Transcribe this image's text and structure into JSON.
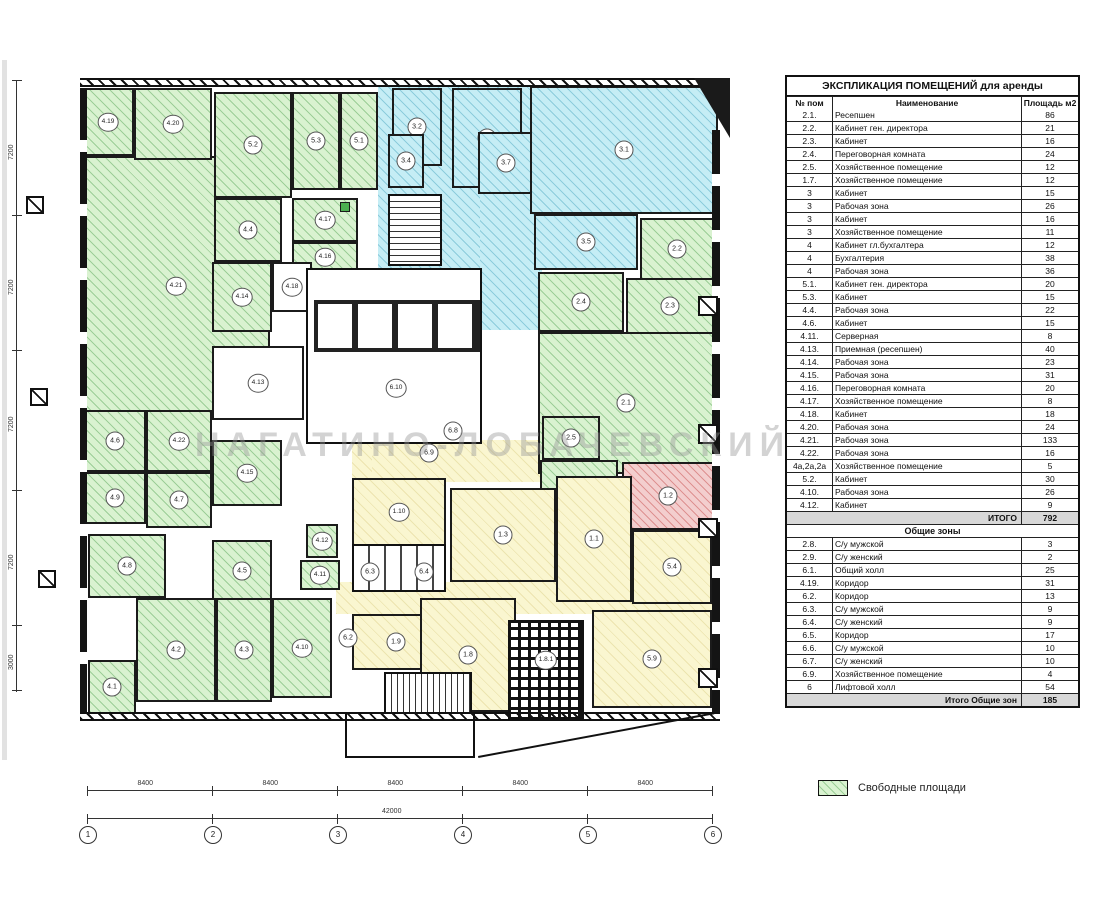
{
  "watermark": "НАГАТИНО-ЛОБАЧЕВСКИЙ",
  "legend": {
    "label": "Свободные площади"
  },
  "table": {
    "title": "ЭКСПЛИКАЦИЯ ПОМЕЩЕНИЙ для аренды",
    "columns": [
      "№ пом",
      "Наименование",
      "Площадь м2"
    ],
    "rows": [
      {
        "n": "2.1.",
        "name": "Ресепшен",
        "area": "86"
      },
      {
        "n": "2.2.",
        "name": "Кабинет ген. директора",
        "area": "21"
      },
      {
        "n": "2.3.",
        "name": "Кабинет",
        "area": "16"
      },
      {
        "n": "2.4.",
        "name": "Переговорная комната",
        "area": "24"
      },
      {
        "n": "2.5.",
        "name": "Хозяйственное помещение",
        "area": "12"
      },
      {
        "n": "1.7.",
        "name": "Хозяйственное помещение",
        "area": "12"
      },
      {
        "n": "3",
        "name": "Кабинет",
        "area": "15"
      },
      {
        "n": "3",
        "name": "Рабочая зона",
        "area": "26"
      },
      {
        "n": "3",
        "name": "Кабинет",
        "area": "16"
      },
      {
        "n": "3",
        "name": "Хозяйственное помещение",
        "area": "11"
      },
      {
        "n": "4",
        "name": "Кабинет гл.бухгалтера",
        "area": "12"
      },
      {
        "n": "4",
        "name": "Бухгалтерия",
        "area": "38"
      },
      {
        "n": "4",
        "name": "Рабочая зона",
        "area": "36"
      },
      {
        "n": "5.1.",
        "name": "Кабинет ген. директора",
        "area": "20"
      },
      {
        "n": "5.3.",
        "name": "Кабинет",
        "area": "15"
      },
      {
        "n": "4.4.",
        "name": "Рабочая зона",
        "area": "22"
      },
      {
        "n": "4.6.",
        "name": "Кабинет",
        "area": "15"
      },
      {
        "n": "4.11.",
        "name": "Серверная",
        "area": "8"
      },
      {
        "n": "4.13.",
        "name": "Приемная (ресепшен)",
        "area": "40"
      },
      {
        "n": "4.14.",
        "name": "Рабочая зона",
        "area": "23"
      },
      {
        "n": "4.15.",
        "name": "Рабочая зона",
        "area": "31"
      },
      {
        "n": "4.16.",
        "name": "Переговорная комната",
        "area": "20"
      },
      {
        "n": "4.17.",
        "name": "Хозяйственное помещение",
        "area": "8"
      },
      {
        "n": "4.18.",
        "name": "Кабинет",
        "area": "18"
      },
      {
        "n": "4.20.",
        "name": "Рабочая зона",
        "area": "24"
      },
      {
        "n": "4.21.",
        "name": "Рабочая зона",
        "area": "133"
      },
      {
        "n": "4.22.",
        "name": "Рабочая зона",
        "area": "16"
      },
      {
        "n": "4а,2а,2а",
        "name": "Хозяйственное помещение",
        "area": "5"
      },
      {
        "n": "5.2.",
        "name": "Кабинет",
        "area": "30"
      },
      {
        "n": "4.10.",
        "name": "Рабочая зона",
        "area": "26"
      },
      {
        "n": "4.12.",
        "name": "Кабинет",
        "area": "9"
      },
      {
        "type": "total",
        "label": "ИТОГО",
        "area": "792"
      },
      {
        "type": "section",
        "label": "Общие зоны"
      },
      {
        "n": "2.8.",
        "name": "С/у мужской",
        "area": "3"
      },
      {
        "n": "2.9.",
        "name": "С/у женский",
        "area": "2"
      },
      {
        "n": "6.1.",
        "name": "Общий холл",
        "area": "25"
      },
      {
        "n": "4.19.",
        "name": "Коридор",
        "area": "31"
      },
      {
        "n": "6.2.",
        "name": "Коридор",
        "area": "13"
      },
      {
        "n": "6.3.",
        "name": "С/у мужской",
        "area": "9"
      },
      {
        "n": "6.4.",
        "name": "С/у женский",
        "area": "9"
      },
      {
        "n": "6.5.",
        "name": "Коридор",
        "area": "17"
      },
      {
        "n": "6.6.",
        "name": "С/у мужской",
        "area": "10"
      },
      {
        "n": "6.7.",
        "name": "С/у женский",
        "area": "10"
      },
      {
        "n": "6.9.",
        "name": "Хозяйственное помещение",
        "area": "4"
      },
      {
        "n": "6",
        "name": "Лифтовой холл",
        "area": "54"
      },
      {
        "type": "total",
        "label": "Итого Общие зон",
        "area": "185"
      }
    ]
  },
  "plan": {
    "rooms": [
      {
        "f": "cn",
        "x": 378,
        "y": 85,
        "w": 164,
        "h": 190
      },
      {
        "f": "cn",
        "x": 480,
        "y": 190,
        "w": 60,
        "h": 140
      },
      {
        "f": "yn",
        "x": 352,
        "y": 440,
        "w": 190,
        "h": 42
      },
      {
        "f": "yn",
        "x": 352,
        "y": 386,
        "w": 20,
        "h": 100
      },
      {
        "f": "yn",
        "x": 336,
        "y": 582,
        "w": 376,
        "h": 32
      },
      {
        "l": "4.21",
        "x": 82,
        "y": 156,
        "w": 188,
        "h": 260,
        "f": "g"
      },
      {
        "l": "4.19",
        "x": 82,
        "y": 88,
        "w": 52,
        "h": 68,
        "f": "g"
      },
      {
        "l": "4.20",
        "x": 134,
        "y": 88,
        "w": 78,
        "h": 72,
        "f": "g"
      },
      {
        "l": "5.2",
        "x": 214,
        "y": 92,
        "w": 78,
        "h": 106,
        "f": "g"
      },
      {
        "l": "5.3",
        "x": 292,
        "y": 92,
        "w": 48,
        "h": 98,
        "f": "g"
      },
      {
        "l": "5.1",
        "x": 340,
        "y": 92,
        "w": 38,
        "h": 98,
        "f": "g"
      },
      {
        "l": "4.4",
        "x": 214,
        "y": 198,
        "w": 68,
        "h": 64,
        "f": "g"
      },
      {
        "l": "4.17",
        "x": 292,
        "y": 198,
        "w": 66,
        "h": 44,
        "f": "g"
      },
      {
        "l": "4.16",
        "x": 292,
        "y": 242,
        "w": 66,
        "h": 30,
        "f": "g"
      },
      {
        "l": "4.14",
        "x": 212,
        "y": 262,
        "w": 60,
        "h": 70,
        "f": "g"
      },
      {
        "l": "4.18",
        "x": 272,
        "y": 262,
        "w": 40,
        "h": 50,
        "f": "w"
      },
      {
        "l": "4.13",
        "x": 212,
        "y": 346,
        "w": 92,
        "h": 74,
        "f": "w"
      },
      {
        "l": "4.6",
        "x": 84,
        "y": 410,
        "w": 62,
        "h": 62,
        "f": "g"
      },
      {
        "l": "4.22",
        "x": 146,
        "y": 410,
        "w": 66,
        "h": 62,
        "f": "g"
      },
      {
        "l": "4.15",
        "x": 212,
        "y": 440,
        "w": 70,
        "h": 66,
        "f": "g"
      },
      {
        "l": "4.9",
        "x": 84,
        "y": 472,
        "w": 62,
        "h": 52,
        "f": "g"
      },
      {
        "l": "4.7",
        "x": 146,
        "y": 472,
        "w": 66,
        "h": 56,
        "f": "g"
      },
      {
        "l": "4.8",
        "x": 88,
        "y": 534,
        "w": 78,
        "h": 64,
        "f": "g"
      },
      {
        "l": "4.5",
        "x": 212,
        "y": 540,
        "w": 60,
        "h": 62,
        "f": "g"
      },
      {
        "l": "4.1",
        "x": 88,
        "y": 660,
        "w": 48,
        "h": 54,
        "f": "g"
      },
      {
        "l": "4.2",
        "x": 136,
        "y": 598,
        "w": 80,
        "h": 104,
        "f": "g"
      },
      {
        "l": "4.3",
        "x": 216,
        "y": 598,
        "w": 56,
        "h": 104,
        "f": "g"
      },
      {
        "l": "4.10",
        "x": 272,
        "y": 598,
        "w": 60,
        "h": 100,
        "f": "g"
      },
      {
        "l": "4.12",
        "x": 306,
        "y": 524,
        "w": 32,
        "h": 34,
        "f": "g"
      },
      {
        "l": "4.11",
        "x": 300,
        "y": 560,
        "w": 40,
        "h": 30,
        "f": "g"
      },
      {
        "l": "3.2",
        "x": 392,
        "y": 88,
        "w": 50,
        "h": 78,
        "f": "c"
      },
      {
        "l": "3.3",
        "x": 452,
        "y": 88,
        "w": 70,
        "h": 100,
        "f": "c"
      },
      {
        "l": "3.4",
        "x": 388,
        "y": 134,
        "w": 36,
        "h": 54,
        "f": "c"
      },
      {
        "l": "3.7",
        "x": 478,
        "y": 132,
        "w": 56,
        "h": 62,
        "f": "c"
      },
      {
        "l": "3.1",
        "x": 530,
        "y": 86,
        "w": 188,
        "h": 128,
        "f": "c"
      },
      {
        "l": "3.5",
        "x": 534,
        "y": 214,
        "w": 104,
        "h": 56,
        "f": "c"
      },
      {
        "l": "2.2",
        "x": 640,
        "y": 218,
        "w": 74,
        "h": 62,
        "f": "g"
      },
      {
        "l": "2.4",
        "x": 538,
        "y": 272,
        "w": 86,
        "h": 60,
        "f": "g"
      },
      {
        "l": "2.3",
        "x": 626,
        "y": 278,
        "w": 88,
        "h": 56,
        "f": "g"
      },
      {
        "l": "2.1",
        "x": 538,
        "y": 332,
        "w": 176,
        "h": 142,
        "f": "g"
      },
      {
        "l": "2.5",
        "x": 542,
        "y": 416,
        "w": 58,
        "h": 44,
        "f": "g"
      },
      {
        "l": "1.7",
        "x": 540,
        "y": 460,
        "w": 78,
        "h": 54,
        "f": "g"
      },
      {
        "l": "1.2",
        "x": 622,
        "y": 462,
        "w": 92,
        "h": 68,
        "f": "p"
      },
      {
        "l": "1.10",
        "x": 352,
        "y": 478,
        "w": 94,
        "h": 68,
        "f": "y"
      },
      {
        "l": "1.3",
        "x": 450,
        "y": 488,
        "w": 106,
        "h": 94,
        "f": "y"
      },
      {
        "l": "1.1",
        "x": 556,
        "y": 476,
        "w": 76,
        "h": 126,
        "f": "y"
      },
      {
        "l": "5.4",
        "x": 632,
        "y": 530,
        "w": 80,
        "h": 74,
        "f": "y"
      },
      {
        "l": "1.9",
        "x": 352,
        "y": 614,
        "w": 88,
        "h": 56,
        "f": "y"
      },
      {
        "l": "1.8",
        "x": 420,
        "y": 598,
        "w": 96,
        "h": 114,
        "f": "y"
      },
      {
        "l": "5.9",
        "x": 592,
        "y": 610,
        "w": 120,
        "h": 98,
        "f": "y"
      },
      {
        "l": "6.10",
        "x": 374,
        "y": 368,
        "w": 44,
        "h": 40,
        "f": "n"
      },
      {
        "l": "6.8",
        "x": 440,
        "y": 420,
        "w": 26,
        "h": 22,
        "f": "n"
      },
      {
        "l": "6.9",
        "x": 416,
        "y": 442,
        "w": 26,
        "h": 22,
        "f": "n"
      },
      {
        "l": "6.3",
        "x": 356,
        "y": 560,
        "w": 28,
        "h": 24,
        "f": "n"
      },
      {
        "l": "6.4",
        "x": 410,
        "y": 560,
        "w": 28,
        "h": 24,
        "f": "n"
      },
      {
        "l": "6.2",
        "x": 334,
        "y": 626,
        "w": 28,
        "h": 24,
        "f": "n"
      },
      {
        "l": "1.8.1",
        "x": 524,
        "y": 646,
        "w": 44,
        "h": 28,
        "f": "n"
      },
      {
        "f": "gs",
        "x": 340,
        "y": 202,
        "w": 10,
        "h": 10
      }
    ],
    "axis": {
      "bubbles": [
        "1",
        "2",
        "3",
        "4",
        "5",
        "6"
      ],
      "segments": [
        "8400",
        "8400",
        "8400",
        "8400",
        "8400"
      ],
      "total": "42000",
      "left": [
        "7200",
        "7200",
        "7200",
        "7200",
        "3000"
      ]
    }
  }
}
